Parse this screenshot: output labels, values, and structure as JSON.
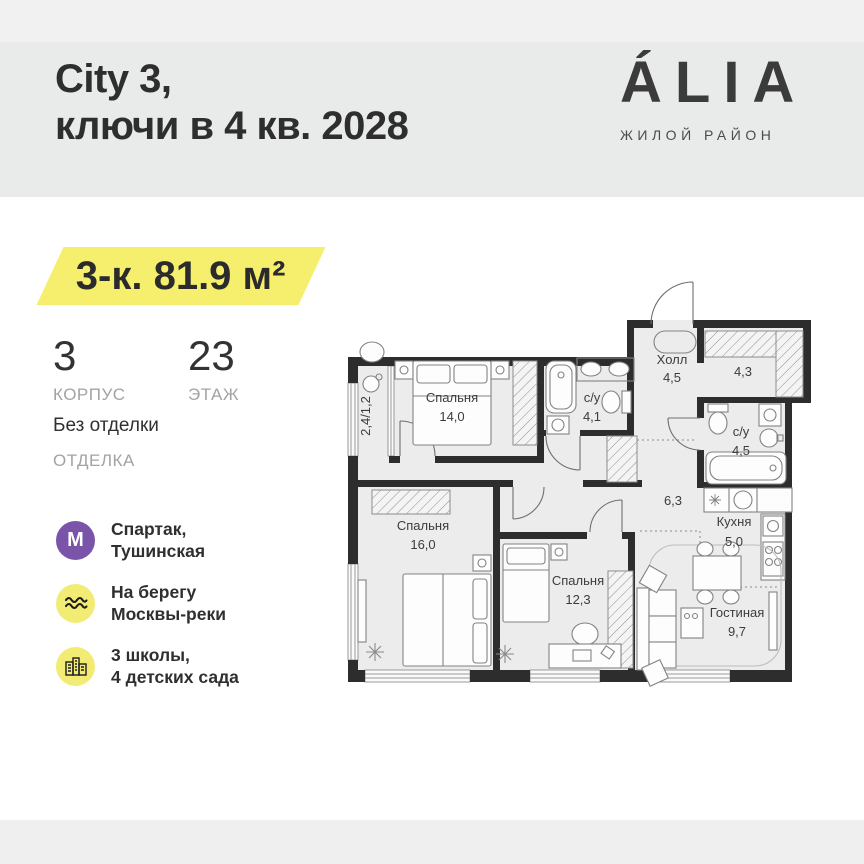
{
  "header": {
    "title_line1": "City 3,",
    "title_line2": "ключи в 4 кв. 2028",
    "brand": "ÁLIA",
    "brand_subtitle": "ЖИЛОЙ РАЙОН"
  },
  "badge": {
    "label": "3-к. 81.9 м²"
  },
  "stats": [
    {
      "value": "3",
      "label": "КОРПУС"
    },
    {
      "value": "23",
      "label": "ЭТАЖ"
    }
  ],
  "finish": {
    "value": "Без отделки",
    "label": "ОТДЕЛКА"
  },
  "amenities": [
    {
      "icon": "metro-icon",
      "letter": "М",
      "line1": "Спартак,",
      "line2": "Тушинская"
    },
    {
      "icon": "river-waves-icon",
      "line1": "На берегу",
      "line2": "Москвы-реки"
    },
    {
      "icon": "school-buildings-icon",
      "line1": "3 школы,",
      "line2": "4 детских сада"
    }
  ],
  "colors": {
    "accent_yellow": "#f5ef6d",
    "metro_purple": "#7a54a8",
    "header_gray": "#e9eaea",
    "wall_dark": "#2d2d2d",
    "floor_gray": "#ececec"
  },
  "plan": {
    "rooms": {
      "bedroom1": {
        "name": "Спальня",
        "area": "14,0"
      },
      "bedroom2": {
        "name": "Спальня",
        "area": "16,0"
      },
      "bedroom3": {
        "name": "Спальня",
        "area": "12,3"
      },
      "bathroom1": {
        "name": "с/у",
        "area": "4,1"
      },
      "bathroom2": {
        "name": "с/у",
        "area": "4,5"
      },
      "hall": {
        "name": "Холл",
        "area": "4,5"
      },
      "closet": {
        "area": "4,3"
      },
      "corridor": {
        "area": "6,3"
      },
      "kitchen": {
        "name": "Кухня",
        "area": "5,0"
      },
      "living": {
        "name": "Гостиная",
        "area": "9,7"
      },
      "balcony": {
        "area": "2,4/1,2"
      }
    }
  }
}
